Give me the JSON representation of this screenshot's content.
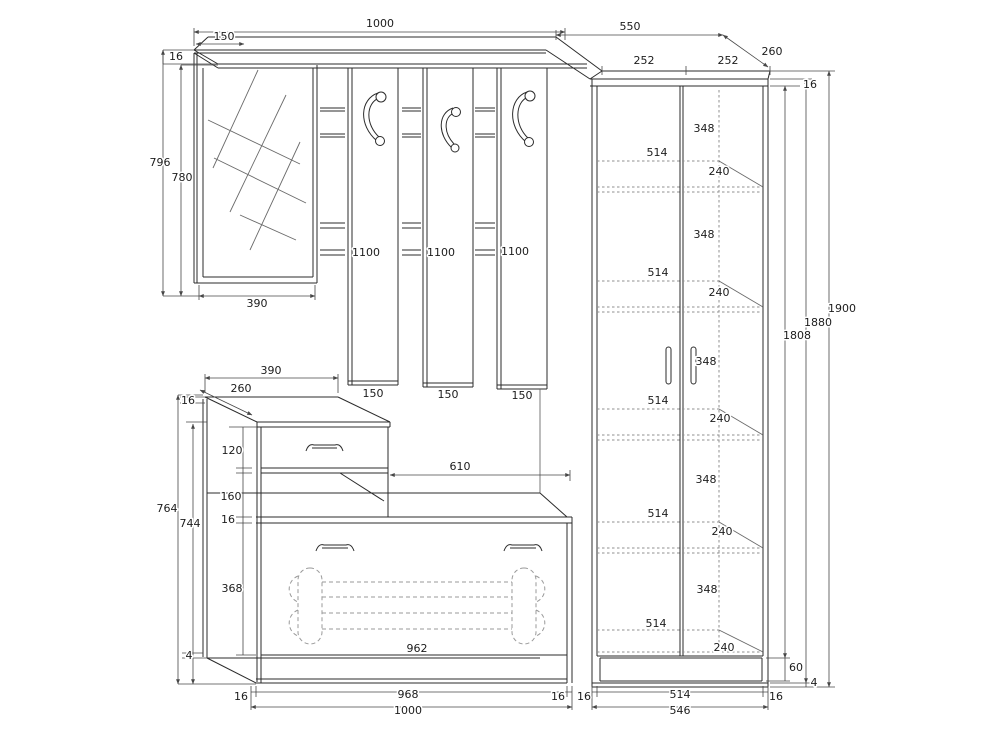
{
  "meta": {
    "drawing": "hallway-furniture-dimension-drawing"
  },
  "colors": {
    "background": "#ffffff",
    "line": "#2b2b2b",
    "dimension": "#474747",
    "hidden_line": "#9a9a9a"
  },
  "top": {
    "total": "1000",
    "offset": "150",
    "thickness_left": "16",
    "right_width": "550",
    "right_depth": "260",
    "door_widths": [
      "252",
      "252"
    ]
  },
  "mirror": {
    "height_outer": "796",
    "height_inner": "780",
    "width": "390"
  },
  "panels": {
    "heights": [
      "1100",
      "1100",
      "1100"
    ],
    "widths": [
      "150",
      "150",
      "150"
    ]
  },
  "cabinet": {
    "top_width": "390",
    "top_depth": "260",
    "top_thickness": "16",
    "drawer_height": "120",
    "open_height": "160",
    "bench_thickness": "16",
    "side_outer": "764",
    "side_inner": "744",
    "flap_height": "368",
    "floor_gap": "4",
    "open_width": "610",
    "flap_width": "962"
  },
  "bottom_left": {
    "wall_left": "16",
    "inner": "968",
    "wall_right": "16",
    "total": "1000"
  },
  "bottom_right": {
    "wall_left": "16",
    "inner": "514",
    "wall_right": "16",
    "total": "546"
  },
  "wardrobe": {
    "gaps": [
      "348",
      "348",
      "348",
      "348",
      "348"
    ],
    "shelf_widths": [
      "514",
      "514",
      "514",
      "514",
      "514"
    ],
    "shelf_depths": [
      "240",
      "240",
      "240",
      "240",
      "240"
    ],
    "height_total": "1900",
    "height_side": "1880",
    "height_front": "1808",
    "top_thickness": "16",
    "plinth_height": "60",
    "floor_gap": "4"
  }
}
